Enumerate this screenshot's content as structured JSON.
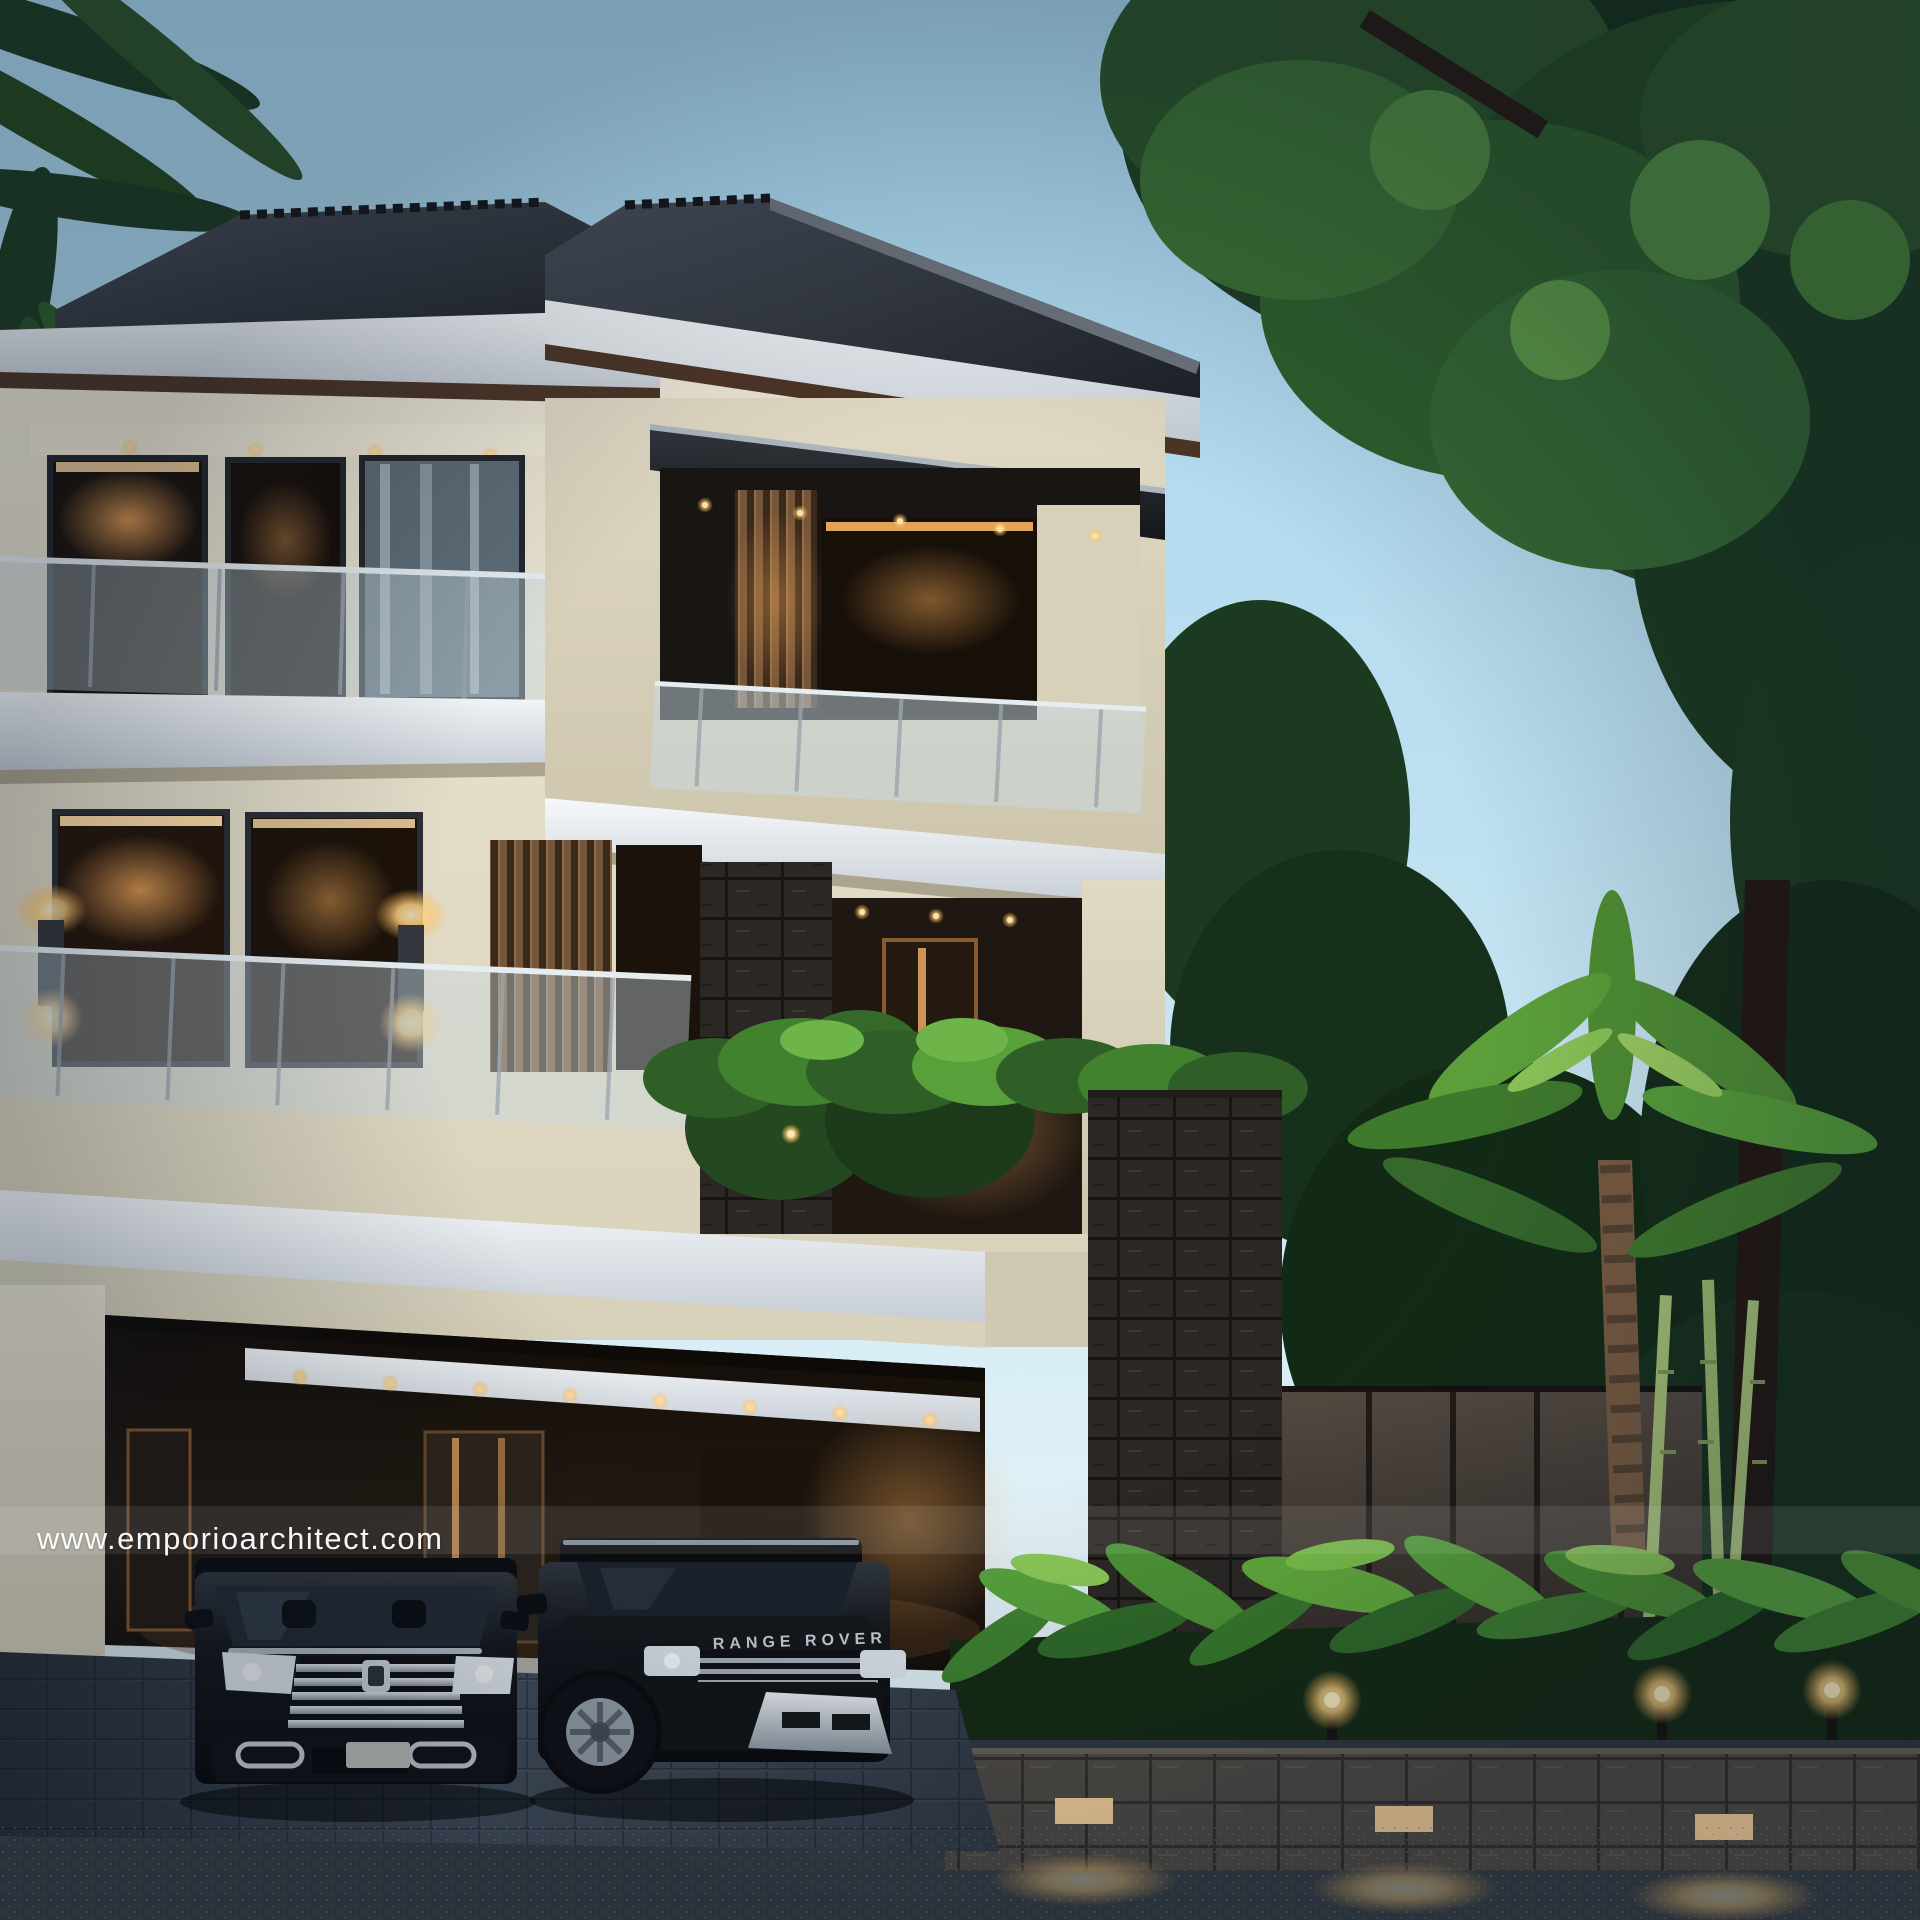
{
  "watermark": {
    "text": "www.emporioarchitect.com",
    "color": "#ffffff"
  },
  "vehicles": {
    "suv_badge": "RANGE ROVER"
  },
  "palette": {
    "sky_top": "#a5d4ec",
    "sky_horizon": "#ecf5f7",
    "roof_dark": "#22262c",
    "fascia_white": "#f0f4f8",
    "under_eave_brown": "#4c3526",
    "wall_cream": "#e8e2cf",
    "wood_slat": "#76563a",
    "dark_stone": "#2c2824",
    "glass_balustrade": "#c7d9e3",
    "warm_light": "#ffd9a0",
    "sconce_glow": "#ffcf7e",
    "foliage_dark": "#16301b",
    "foliage_mid": "#2f5e2c",
    "foliage_bright": "#63ac3c",
    "driveway_paver": "#4f5a67",
    "asphalt": "#363d44",
    "car_black": "#0b0d10",
    "chrome": "#c7ced4",
    "planter_stone": "#514c45"
  }
}
